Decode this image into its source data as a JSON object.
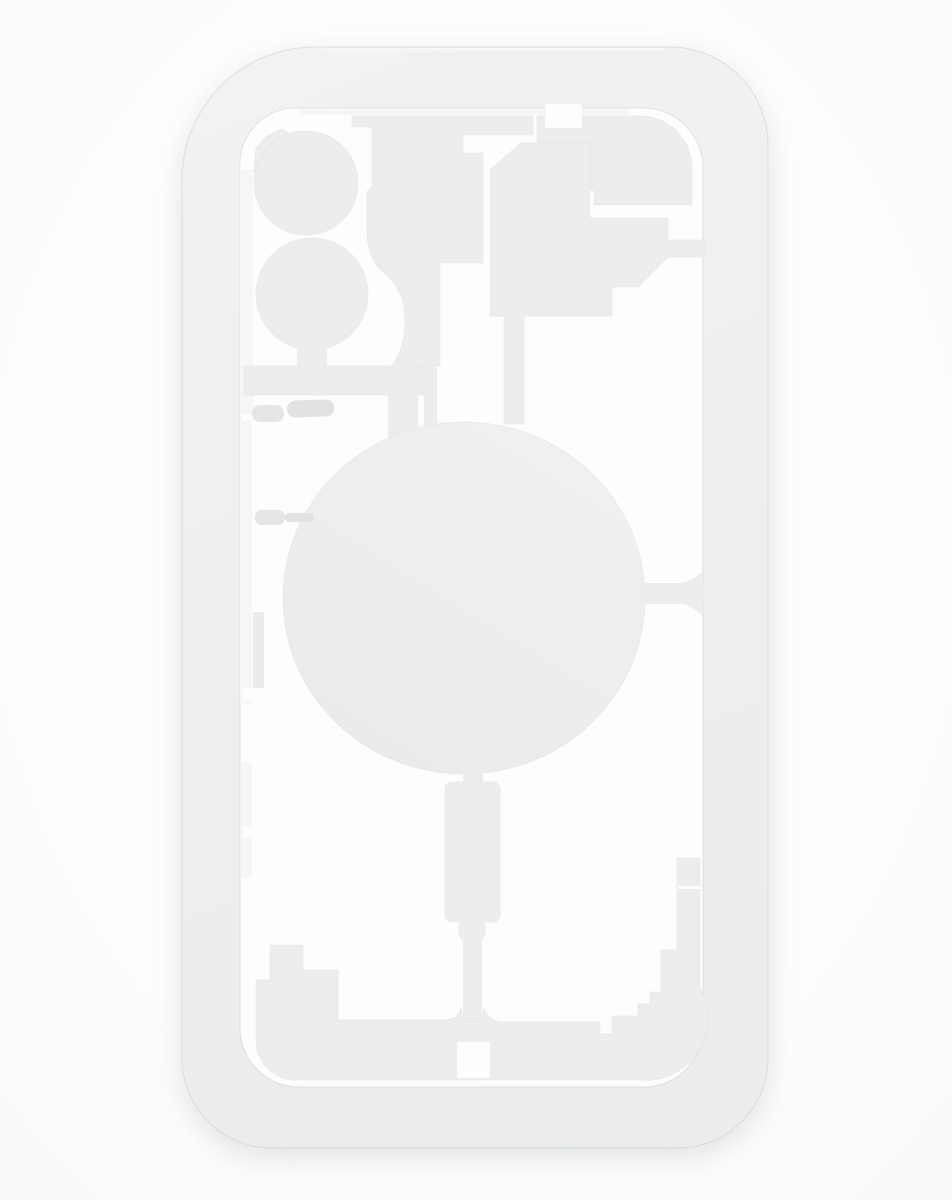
{
  "scene": {
    "type": "product-photo",
    "subject": "White laser machine protection positioning mold for smartphone back glass removal",
    "description": "Top-down photo of a light grey-white rounded rectangular mold plate with a phone-back shaped through cutout. Inside the cutout are islands: a dual camera lens cluster at top left, stepped plates at top right, a large central wireless-charging circle, a vertical pill below it, side button rods on the left, and a stepped bottom island with a small port hole. Islands are attached by thin stems and bridges; all cuts show the white background through.",
    "background_color": "#fdfdfd",
    "object_count": 1,
    "text_visible": false
  },
  "object": {
    "name": "back-glass-laser-mold-plate",
    "parts": [
      "outer rounded plate frame",
      "phone-shaped cutout",
      "upper camera lens island",
      "lower camera lens island",
      "camera corner tab",
      "top bar island with notch",
      "top-right stepped island",
      "right stepped island with frame bridge",
      "central wireless charging circle island",
      "circle-to-frame right bridge",
      "vertical pill island with bump",
      "bottom stepped island",
      "charge port hole",
      "volume button rods",
      "power button rod"
    ]
  },
  "colors": {
    "background": "#fdfdfd",
    "background_edge": "#f8f9f9",
    "plate_top": "#f1f2f3",
    "plate_bottom": "#eaeced",
    "island": "#ecedef",
    "circle_top": "#eef0f1",
    "circle_bottom": "#e9ebed",
    "cut_white": "#fdfdfe",
    "rod": "#e3e5e7",
    "rod_dark": "#e0e2e4",
    "wall_highlight": "#f5f6f7",
    "wall_shade": "#eaecec",
    "edge_highlight": "#f9fafb"
  }
}
